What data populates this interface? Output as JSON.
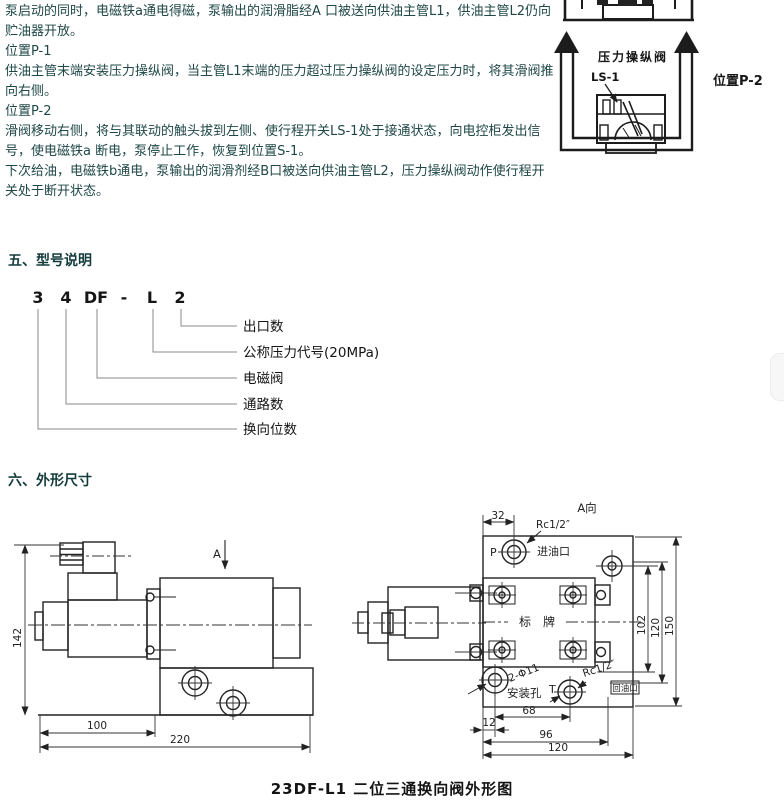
{
  "intro": {
    "paragraphs": [
      "泵启动的同时，电磁铁a通电得磁，泵输出的润滑脂经A 口被送向供油主管L1，供油主管L2仍向贮油器开放。",
      "位置P-1",
      "供油主管末端安装压力操纵阀，当主管L1末端的压力超过压力操纵阀的设定压力时，将其滑阀推向右侧。",
      "位置P-2",
      "滑阀移动右侧，将与其联动的触头拔到左侧、使行程开关LS-1处于接通状态，向电控柜发出信号，使电磁铁a 断电，泵停止工作，恢复到位置S-1。",
      "下次给油，电磁铁b通电，泵输出的润滑剂经B口被送向供油主管L2，压力操纵阀动作使行程开关处于断开状态。"
    ]
  },
  "pressure_valve_diagram": {
    "title": "压力操纵阀",
    "switch_label": "LS-1",
    "position_label": "位置P-2"
  },
  "model_section": {
    "title": "五、型号说明",
    "code_parts": [
      "3",
      "4",
      "DF",
      "-",
      "L",
      "2"
    ],
    "meanings": [
      "出口数",
      "公称压力代号(20MPa)",
      "电磁阀",
      "通路数",
      "换向位数"
    ]
  },
  "dimensions_section": {
    "title": "六、外形尺寸",
    "view_arrow_label": "A",
    "side_view": {
      "dim_height": "142",
      "dim_100": "100",
      "dim_220": "220"
    },
    "top_view": {
      "label": "A向",
      "dim_32": "32",
      "thread_inlet": "Rc1/2″",
      "port_p": "P",
      "inlet_label": "进油口",
      "nameplate": "标　牌",
      "dim_102": "102",
      "dim_120_side": "120",
      "dim_150": "150",
      "holes_label": "2-Φ11",
      "mount_label": "安装孔",
      "port_t": "T",
      "thread_outlet": "Rc1/2″",
      "outlet_label": "回油口",
      "dim_68": "68",
      "dim_12": "12",
      "dim_96": "96",
      "dim_120_bottom": "120"
    },
    "caption": "23DF-L1 二位三通换向阀外形图"
  }
}
